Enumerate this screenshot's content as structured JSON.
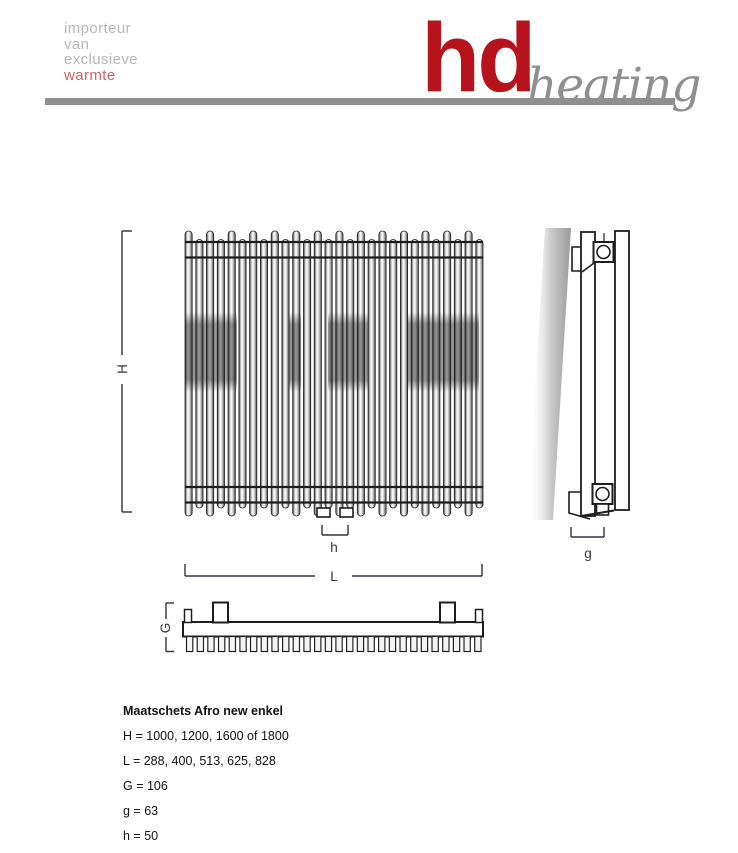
{
  "header": {
    "tagline": [
      "importeur",
      "van",
      "exclusieve",
      "warmte"
    ],
    "brand": "hd",
    "brand_suffix": "heating",
    "colors": {
      "brand_red": "#b7131d",
      "tagline_gray": "#b7b7b7",
      "tagline_accent": "#d4606b",
      "rule_gray": "#8f8f8f"
    }
  },
  "drawing": {
    "labels": {
      "H": "H",
      "L": "L",
      "h": "h",
      "g": "g",
      "G": "G"
    },
    "front_tube_count": 28,
    "bottom_tooth_count": 28
  },
  "specs": {
    "title": "Maatschets Afro new enkel",
    "lines": [
      "H = 1000, 1200, 1600 of 1800",
      "L = 288, 400, 513, 625, 828",
      "G = 106",
      "g = 63",
      "h = 50"
    ]
  }
}
